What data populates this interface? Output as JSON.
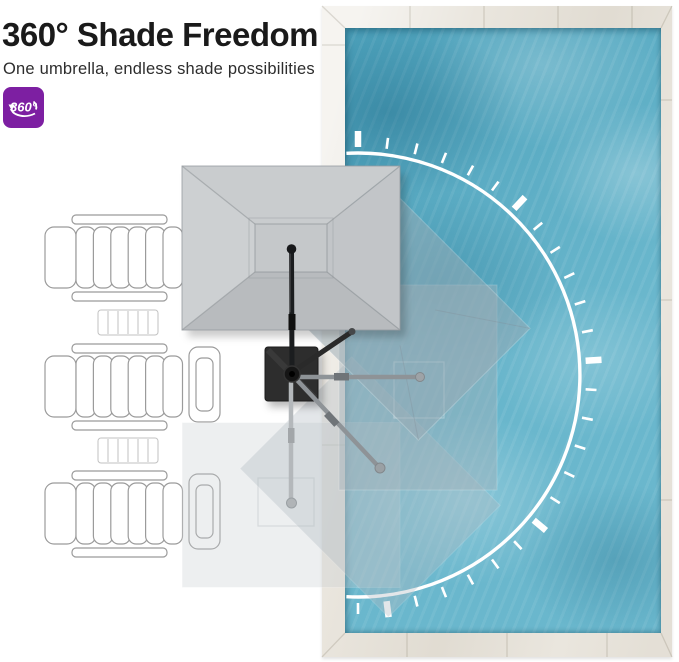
{
  "header": {
    "title": "360° Shade Freedom",
    "subtitle": "One umbrella, endless shade possibilities"
  },
  "badge": {
    "label": "360°",
    "color": "#7D1FA2"
  },
  "palette": {
    "title_text": "#1A1A1A",
    "subtitle_text": "#2D2D2D",
    "pool_water": "#59AFC7",
    "pool_deck": "#EAE6DE",
    "canopy_gray": "#C6C9CC",
    "umbrella_base": "#2D2D2D",
    "rotation_arc": "#FFFFFF"
  },
  "scene": {
    "umbrella_positions": [
      "north-over-loungers",
      "northeast",
      "east-over-pool",
      "southeast",
      "south"
    ],
    "lounger_count": 3,
    "side_table_count": 2,
    "end_table_count": 2,
    "rotation_arc_tick_count": 26
  }
}
